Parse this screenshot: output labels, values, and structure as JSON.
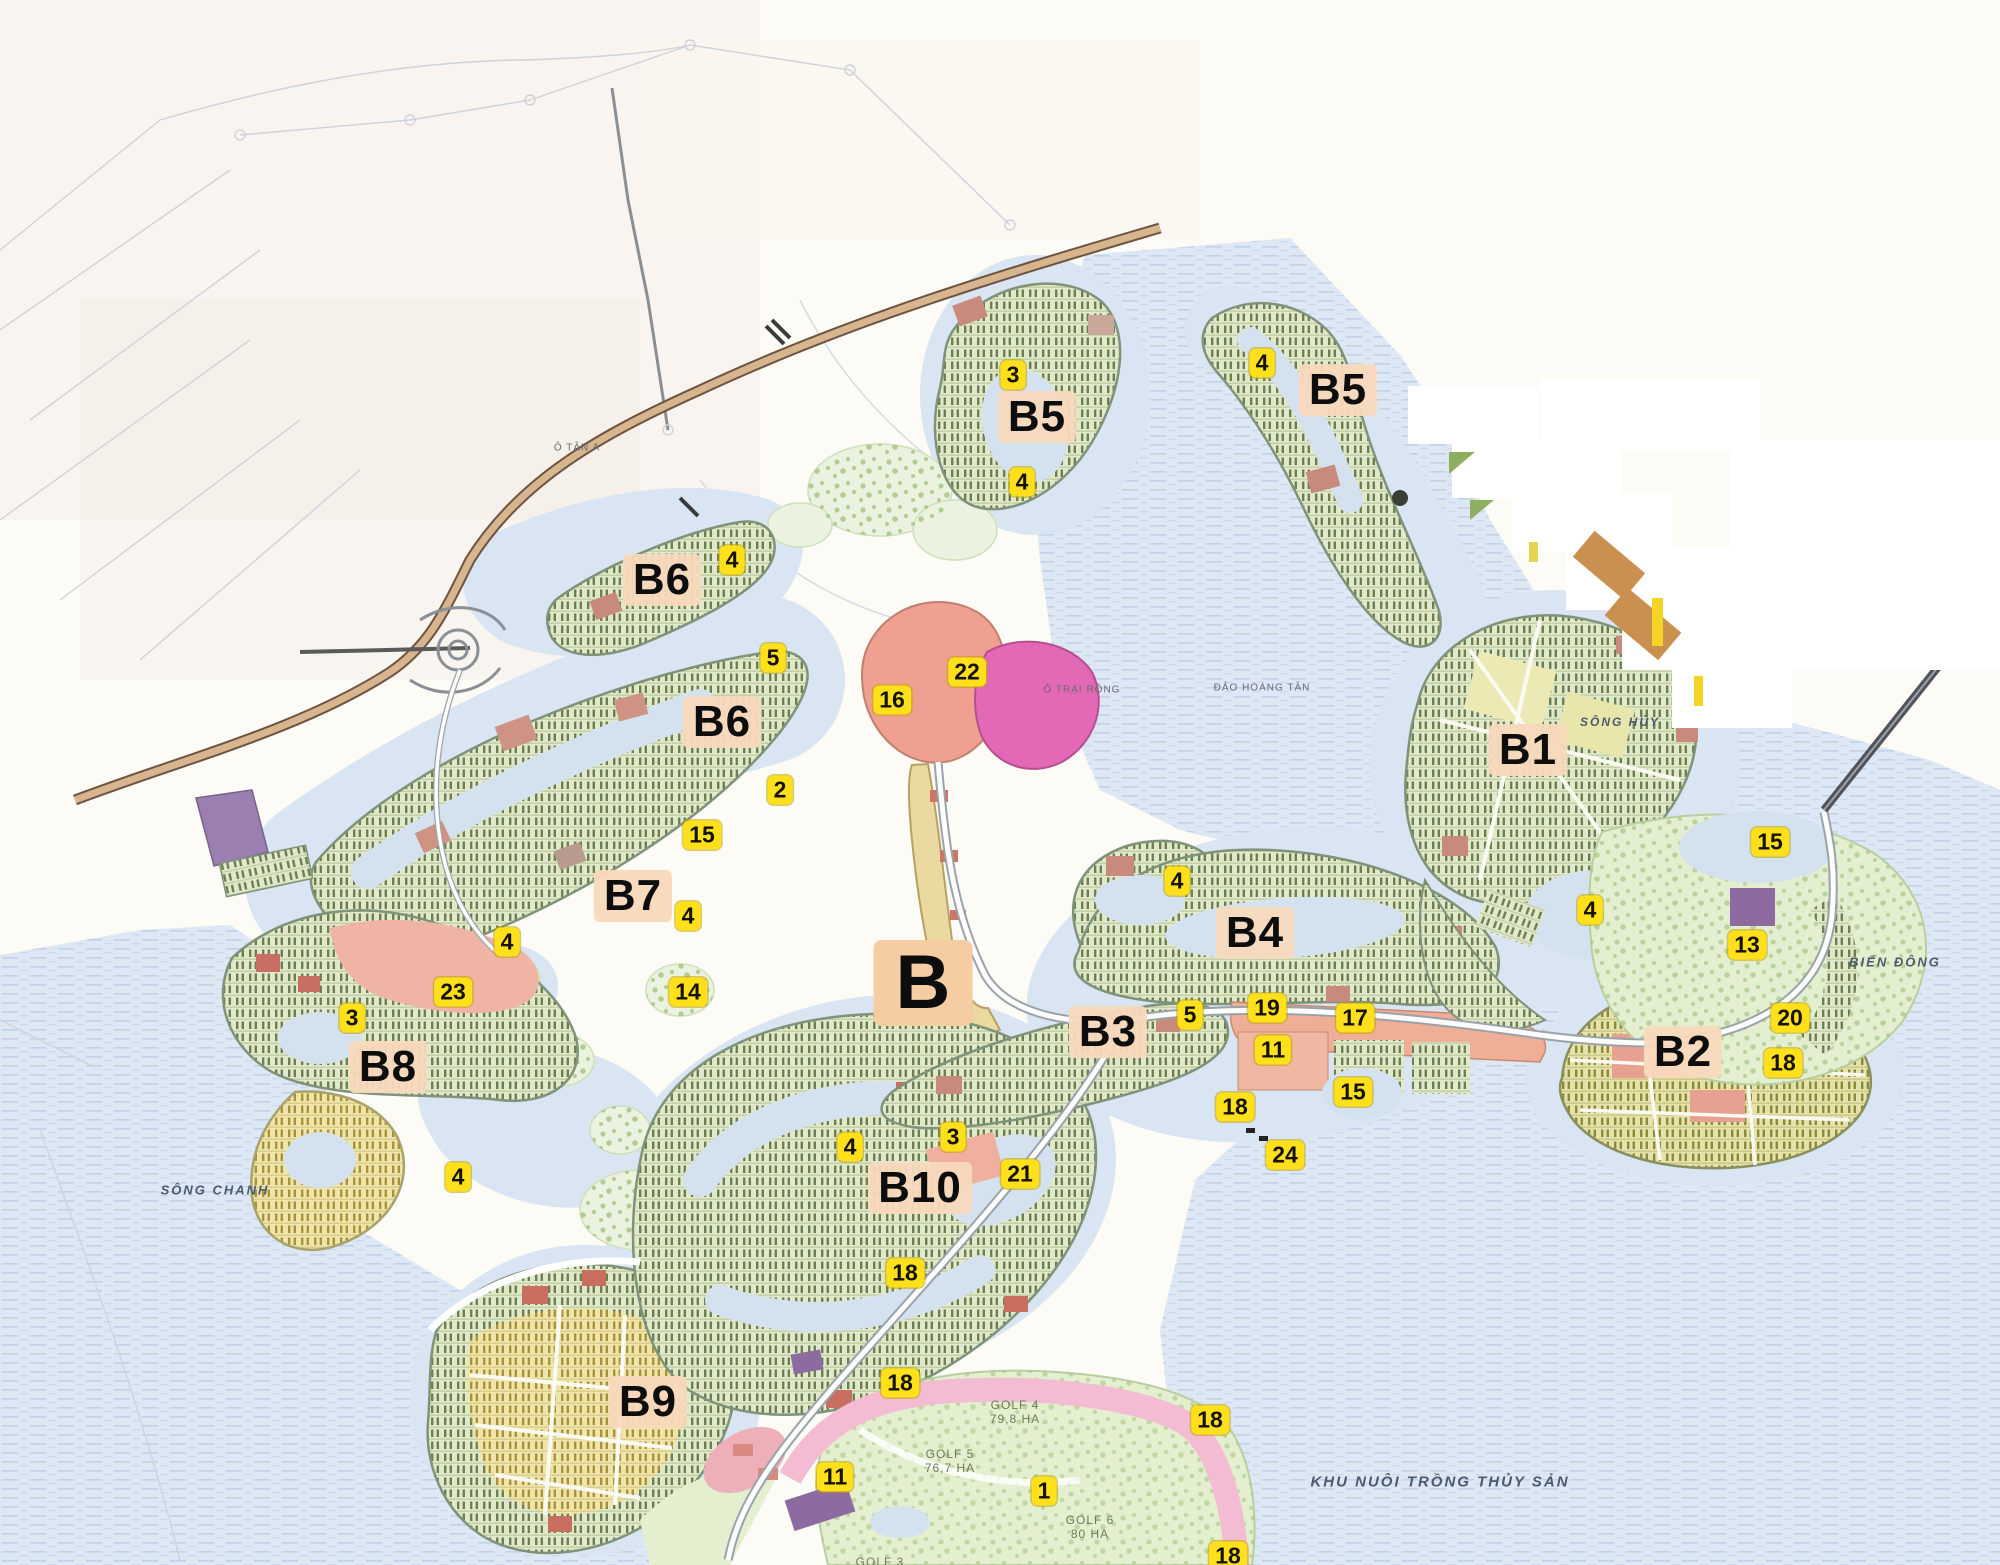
{
  "map": {
    "super_label": {
      "label": "B",
      "x": 923,
      "y": 983
    },
    "zone_labels": [
      {
        "label": "B5",
        "x": 1037,
        "y": 417
      },
      {
        "label": "B5",
        "x": 1338,
        "y": 390
      },
      {
        "label": "B6",
        "x": 662,
        "y": 580
      },
      {
        "label": "B6",
        "x": 722,
        "y": 722
      },
      {
        "label": "B7",
        "x": 633,
        "y": 896
      },
      {
        "label": "B8",
        "x": 388,
        "y": 1067
      },
      {
        "label": "B9",
        "x": 648,
        "y": 1402
      },
      {
        "label": "B10",
        "x": 920,
        "y": 1188
      },
      {
        "label": "B1",
        "x": 1528,
        "y": 750
      },
      {
        "label": "B2",
        "x": 1683,
        "y": 1052
      },
      {
        "label": "B3",
        "x": 1108,
        "y": 1032
      },
      {
        "label": "B4",
        "x": 1255,
        "y": 933
      }
    ],
    "markers": [
      {
        "label": "3",
        "x": 1013,
        "y": 375
      },
      {
        "label": "4",
        "x": 1022,
        "y": 482
      },
      {
        "label": "4",
        "x": 1262,
        "y": 363
      },
      {
        "label": "4",
        "x": 732,
        "y": 560
      },
      {
        "label": "5",
        "x": 773,
        "y": 658
      },
      {
        "label": "2",
        "x": 780,
        "y": 790
      },
      {
        "label": "15",
        "x": 702,
        "y": 835
      },
      {
        "label": "4",
        "x": 688,
        "y": 916
      },
      {
        "label": "16",
        "x": 892,
        "y": 700
      },
      {
        "label": "22",
        "x": 967,
        "y": 672
      },
      {
        "label": "4",
        "x": 507,
        "y": 942
      },
      {
        "label": "23",
        "x": 453,
        "y": 992
      },
      {
        "label": "3",
        "x": 352,
        "y": 1018
      },
      {
        "label": "14",
        "x": 688,
        "y": 992
      },
      {
        "label": "4",
        "x": 458,
        "y": 1177
      },
      {
        "label": "4",
        "x": 1177,
        "y": 881
      },
      {
        "label": "5",
        "x": 1190,
        "y": 1015
      },
      {
        "label": "19",
        "x": 1267,
        "y": 1008
      },
      {
        "label": "17",
        "x": 1355,
        "y": 1018
      },
      {
        "label": "11",
        "x": 1273,
        "y": 1050
      },
      {
        "label": "15",
        "x": 1353,
        "y": 1092
      },
      {
        "label": "18",
        "x": 1235,
        "y": 1107
      },
      {
        "label": "24",
        "x": 1285,
        "y": 1155
      },
      {
        "label": "4",
        "x": 1590,
        "y": 910
      },
      {
        "label": "15",
        "x": 1770,
        "y": 842
      },
      {
        "label": "13",
        "x": 1747,
        "y": 945
      },
      {
        "label": "20",
        "x": 1790,
        "y": 1018
      },
      {
        "label": "18",
        "x": 1783,
        "y": 1063
      },
      {
        "label": "4",
        "x": 850,
        "y": 1147
      },
      {
        "label": "3",
        "x": 953,
        "y": 1137
      },
      {
        "label": "21",
        "x": 1020,
        "y": 1174
      },
      {
        "label": "18",
        "x": 905,
        "y": 1273
      },
      {
        "label": "18",
        "x": 900,
        "y": 1383
      },
      {
        "label": "11",
        "x": 835,
        "y": 1477
      },
      {
        "label": "1",
        "x": 1044,
        "y": 1491
      },
      {
        "label": "18",
        "x": 1210,
        "y": 1420
      },
      {
        "label": "18",
        "x": 1228,
        "y": 1556
      }
    ],
    "place_labels": [
      {
        "text": "SÔNG CHANH",
        "x": 215,
        "y": 1190,
        "size": 13,
        "style": "water"
      },
      {
        "text": "SÔNG HỦY",
        "x": 1620,
        "y": 722,
        "size": 12,
        "style": "water"
      },
      {
        "text": "BIỂN ĐÔNG",
        "x": 1895,
        "y": 962,
        "size": 13,
        "style": "water"
      },
      {
        "text": "KHU NUÔI TRỒNG THỦY SẢN",
        "x": 1440,
        "y": 1482,
        "size": 15,
        "style": "water"
      },
      {
        "text": "GOLF 4\n79,8 HA",
        "x": 1015,
        "y": 1412,
        "size": 12,
        "style": "golf"
      },
      {
        "text": "GOLF 5\n76,7 HA",
        "x": 950,
        "y": 1461,
        "size": 12,
        "style": "golf"
      },
      {
        "text": "GOLF 6\n80 HA",
        "x": 1090,
        "y": 1527,
        "size": 12,
        "style": "golf"
      },
      {
        "text": "GOLF 3",
        "x": 880,
        "y": 1562,
        "size": 12,
        "style": "golf"
      },
      {
        "text": "Ô TRẠI RỒNG",
        "x": 1082,
        "y": 690,
        "size": 10,
        "style": "tiny"
      },
      {
        "text": "ĐẢO HOÀNG TÂN",
        "x": 1262,
        "y": 688,
        "size": 10,
        "style": "tiny"
      },
      {
        "text": "Ô TÂN A",
        "x": 577,
        "y": 448,
        "size": 10,
        "style": "tiny"
      }
    ],
    "colors": {
      "marker_bg": "#ffe01a",
      "zone_chip_bg": "#f8d9bc",
      "water": "#dde8f4",
      "parcel_green": "#e1e9cd",
      "parcel_hatch": "#6d7f4e",
      "parcel_yellow": "#efe5ab",
      "pink_zone": "#efae96",
      "magenta_zone": "#e368b5",
      "purple_zone": "#8d6ba0",
      "highway": "#d7b58f",
      "golf_green": "#e3efcf"
    }
  }
}
